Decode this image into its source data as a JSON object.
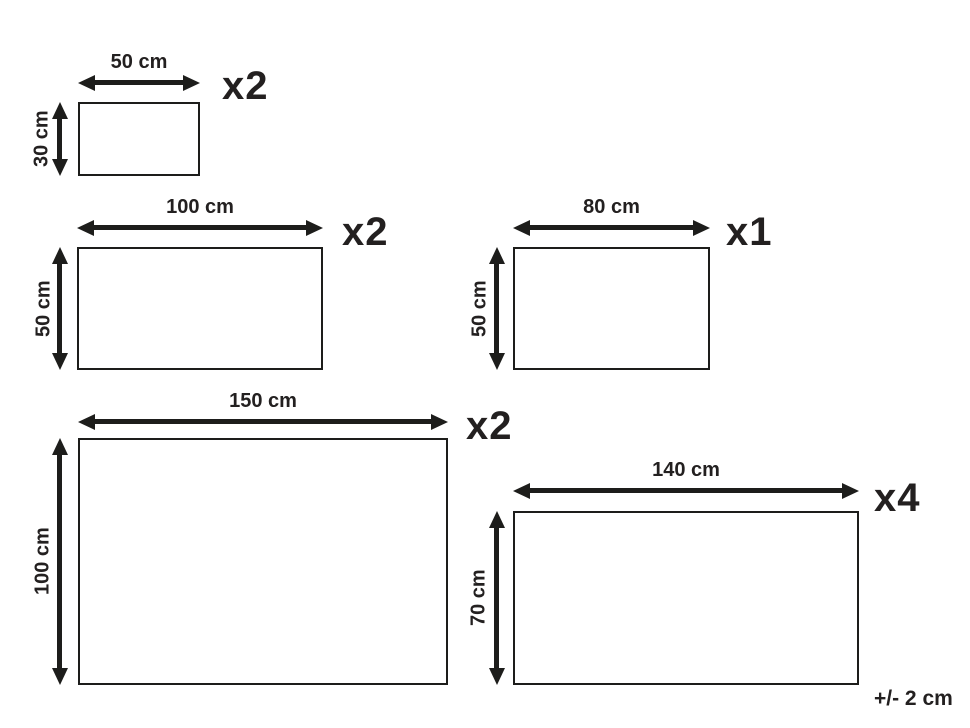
{
  "figures": [
    {
      "name": "rectangle-50x30",
      "width_cm": 50,
      "height_cm": 30,
      "quantity": 2,
      "width_label": "50 cm",
      "height_label": "30 cm",
      "count_label": "x2"
    },
    {
      "name": "rectangle-100x50",
      "width_cm": 100,
      "height_cm": 50,
      "quantity": 2,
      "width_label": "100 cm",
      "height_label": "50 cm",
      "count_label": "x2"
    },
    {
      "name": "rectangle-80x50",
      "width_cm": 80,
      "height_cm": 50,
      "quantity": 1,
      "width_label": "80 cm",
      "height_label": "50 cm",
      "count_label": "x1"
    },
    {
      "name": "rectangle-150x100",
      "width_cm": 150,
      "height_cm": 100,
      "quantity": 2,
      "width_label": "150 cm",
      "height_label": "100 cm",
      "count_label": "x2"
    },
    {
      "name": "rectangle-140x70",
      "width_cm": 140,
      "height_cm": 70,
      "quantity": 4,
      "width_label": "140 cm",
      "height_label": "70 cm",
      "count_label": "x4"
    }
  ],
  "footer": {
    "tolerance_label": "+/- 2 cm"
  },
  "colors": {
    "line": "#1d1d1b",
    "text": "#232020",
    "background": "#ffffff"
  }
}
